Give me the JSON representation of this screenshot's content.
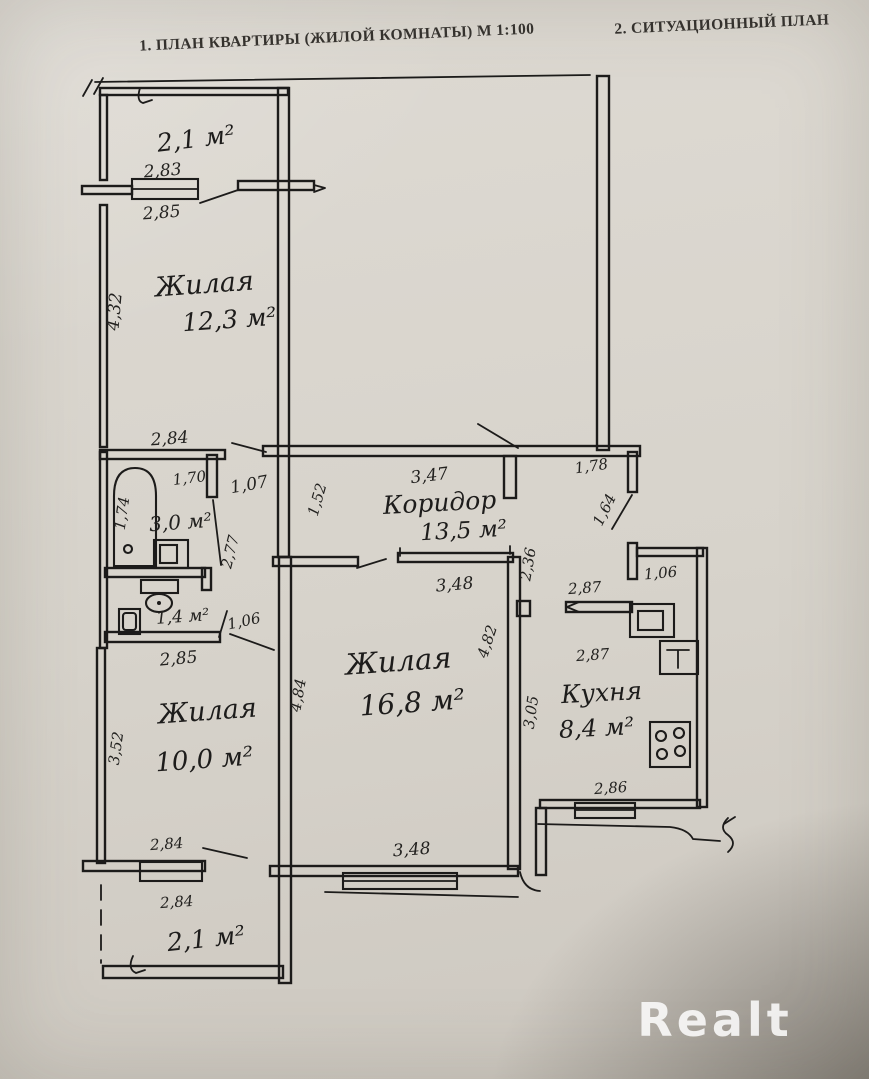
{
  "header": {
    "title_left": "1. ПЛАН КВАРТИРЫ (ЖИЛОЙ КОМНАТЫ) М 1:100",
    "title_right": "2. СИТУАЦИОННЫЙ ПЛАН"
  },
  "watermark": "Realt",
  "rooms": {
    "balcony_top": {
      "area": "2,1 м²"
    },
    "living_1": {
      "label": "Жилая",
      "area": "12,3 м²"
    },
    "bathroom": {
      "area": "3,0 м²"
    },
    "toilet": {
      "area": "1,4 м²"
    },
    "corridor": {
      "label": "Коридор",
      "area": "13,5 м²"
    },
    "living_2": {
      "label": "Жилая",
      "area": "16,8 м²"
    },
    "kitchen": {
      "label": "Кухня",
      "area": "8,4 м²"
    },
    "living_3": {
      "label": "Жилая",
      "area": "10,0 м²"
    },
    "balcony_bottom": {
      "area": "2,1 м²"
    }
  },
  "dims": {
    "d283": "2,83",
    "d285_top": "2,85",
    "d432": "4,32",
    "d284_top": "2,84",
    "d170": "1,70",
    "d174": "1,74",
    "d107": "1,07",
    "d277": "2,77",
    "d152": "1,52",
    "d347": "3,47",
    "d178": "1,78",
    "d164": "1,64",
    "d236": "2,36",
    "d348_top": "3,48",
    "d106_niche": "1,06",
    "d287_a": "2,87",
    "d287_b": "2,87",
    "d482": "4,82",
    "d484": "4,84",
    "d305": "3,05",
    "d286": "2,86",
    "d106_toilet": "1,06",
    "d285_bottom": "2,85",
    "d352": "3,52",
    "d348_bottom": "3,48",
    "d284_mid": "2,84",
    "d284_low": "2,84"
  }
}
